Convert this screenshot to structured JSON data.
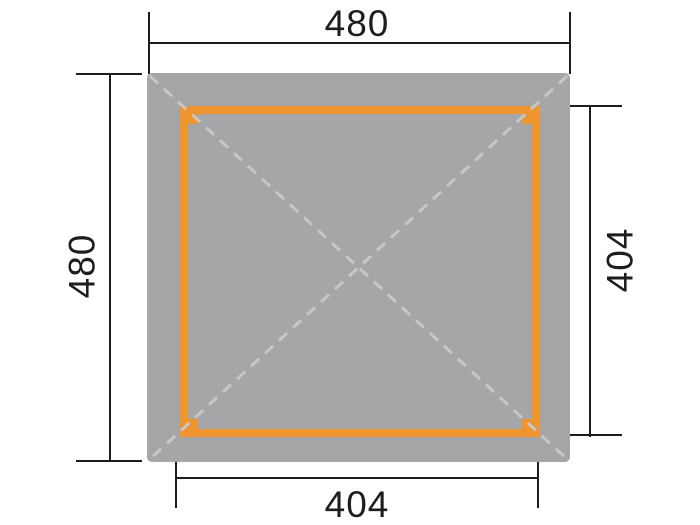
{
  "diagram": {
    "dimensions": {
      "top": "480",
      "left": "480",
      "right": "404",
      "bottom": "404"
    },
    "colors": {
      "bg": "#ffffff",
      "roof": "#a6a6a8",
      "frame": "#ee9530",
      "dash": "#c7c7c9",
      "line": "#1d1d1b"
    }
  }
}
